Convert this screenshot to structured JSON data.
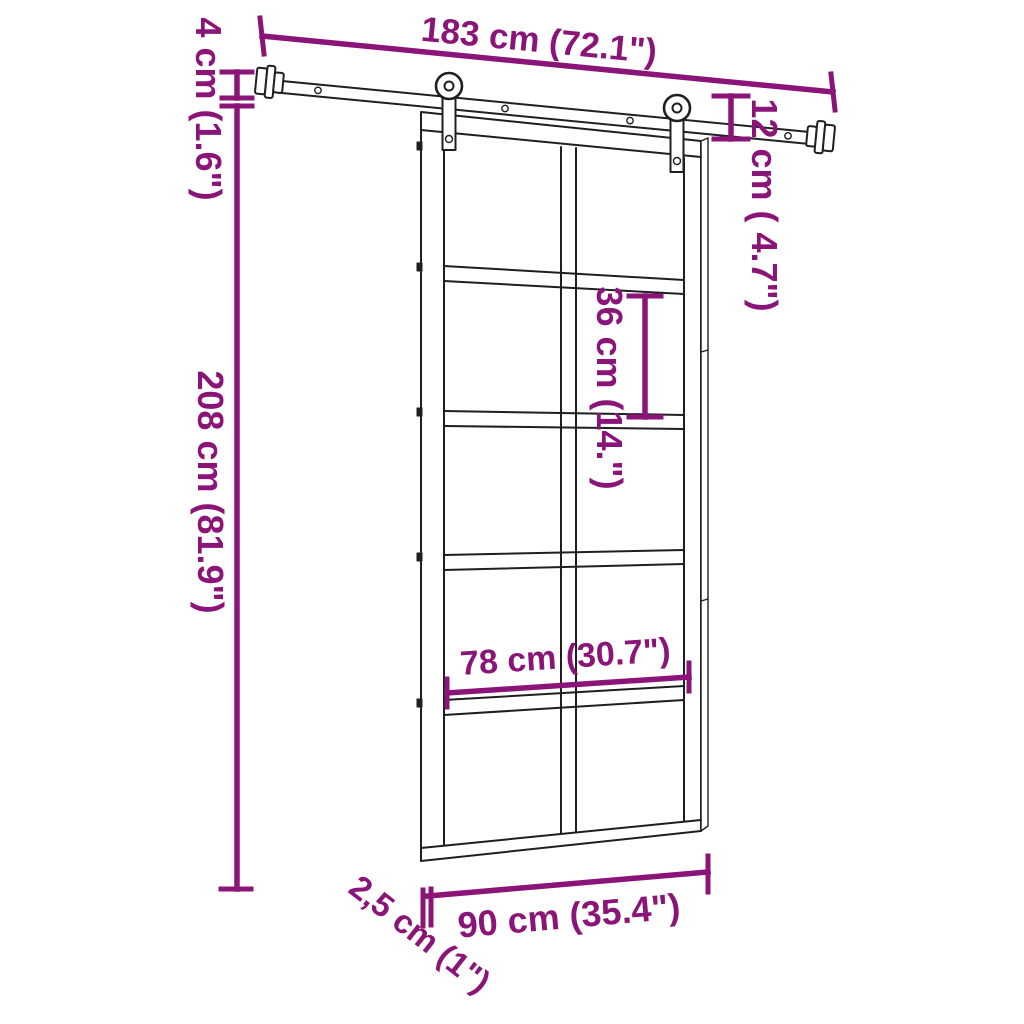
{
  "colors": {
    "dimension": "#8B1478",
    "outline": "#1f1f1f",
    "background": "#ffffff"
  },
  "diagram": {
    "description": "Sliding barn door with steel hardware kit - dimension drawing",
    "dimension_labels": {
      "rail_length": "183 cm (72.1\")",
      "rail_profile_height": "4 cm (1.6\")",
      "door_height": "208 cm (81.9\")",
      "hanger_offset": "12 cm ( 4.7\")",
      "pane_height": "36 cm (14.\")",
      "inner_width": "78 cm (30.7\")",
      "door_width": "90 cm (35.4\")",
      "door_thickness": "2,5 cm (1\")"
    }
  }
}
